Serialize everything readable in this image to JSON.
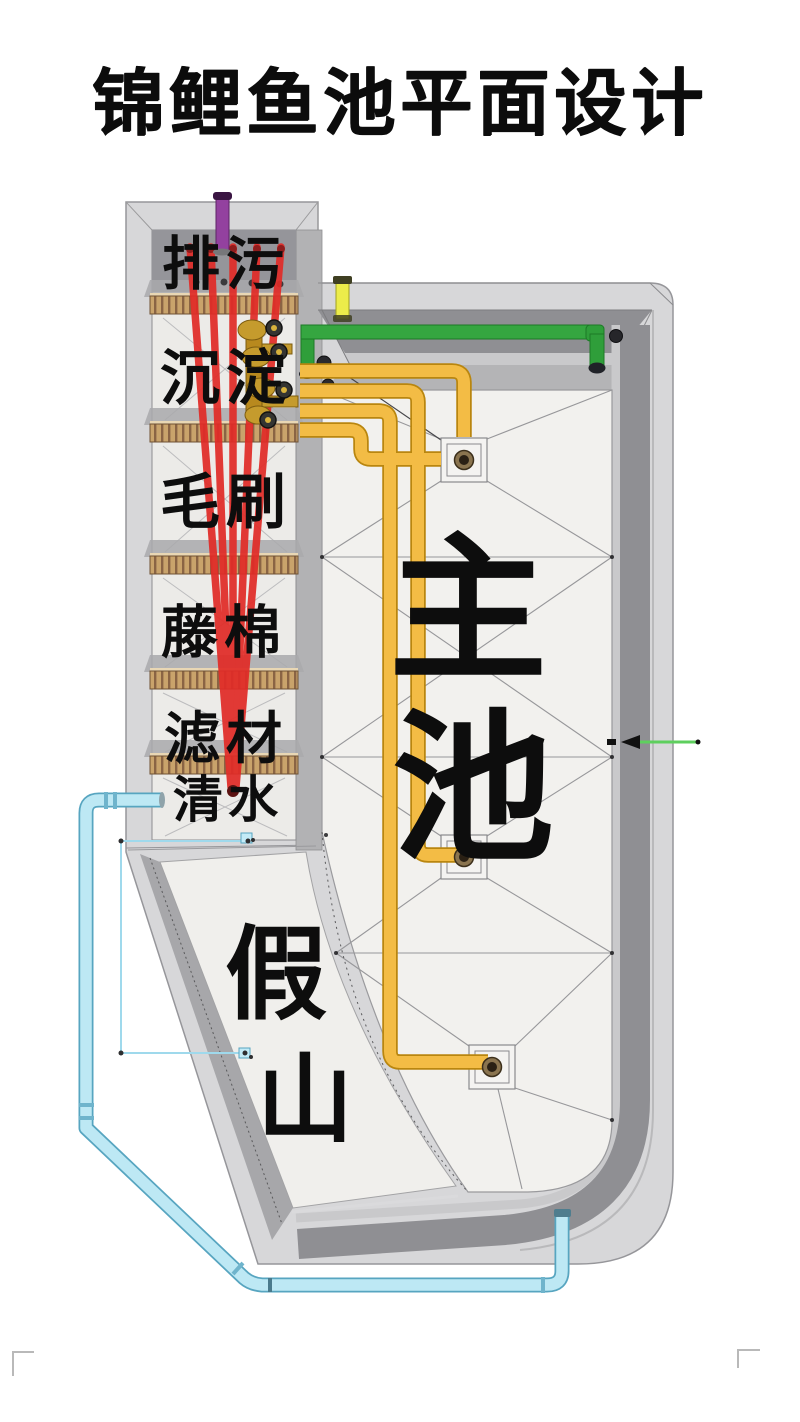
{
  "title": "锦鲤鱼池平面设计",
  "labels": {
    "chambers": [
      {
        "label": "排污"
      },
      {
        "label": "沉淀"
      },
      {
        "label": "毛刷"
      },
      {
        "label": "藤棉"
      },
      {
        "label": "滤材"
      },
      {
        "label": "清水"
      }
    ],
    "pool": [
      "主",
      "池"
    ],
    "rockery": [
      "假",
      "山"
    ]
  },
  "colors": {
    "title_text": "#0c0c0c",
    "structure_gray": "#d7d7d9",
    "wall_dark_gray": "#8f8f93",
    "pool_floor": "#f2f1ee",
    "drain_pipe_red": "#e12c28",
    "bottom_drain_pipe_yellow": "#f0b43a",
    "return_pipe_green": "#2f9e3a",
    "overflow_pipe_cyan": "#c3ebf7",
    "vent_pipe_purple": "#93419f",
    "standpipe_yellow": "#ecec4a",
    "valve_brass": "#c59b2d",
    "grate_tan": "#c9a36b",
    "dimension_line_cyan": "#9fd9ec",
    "dimension_arrow_green": "#5ecf5e"
  }
}
